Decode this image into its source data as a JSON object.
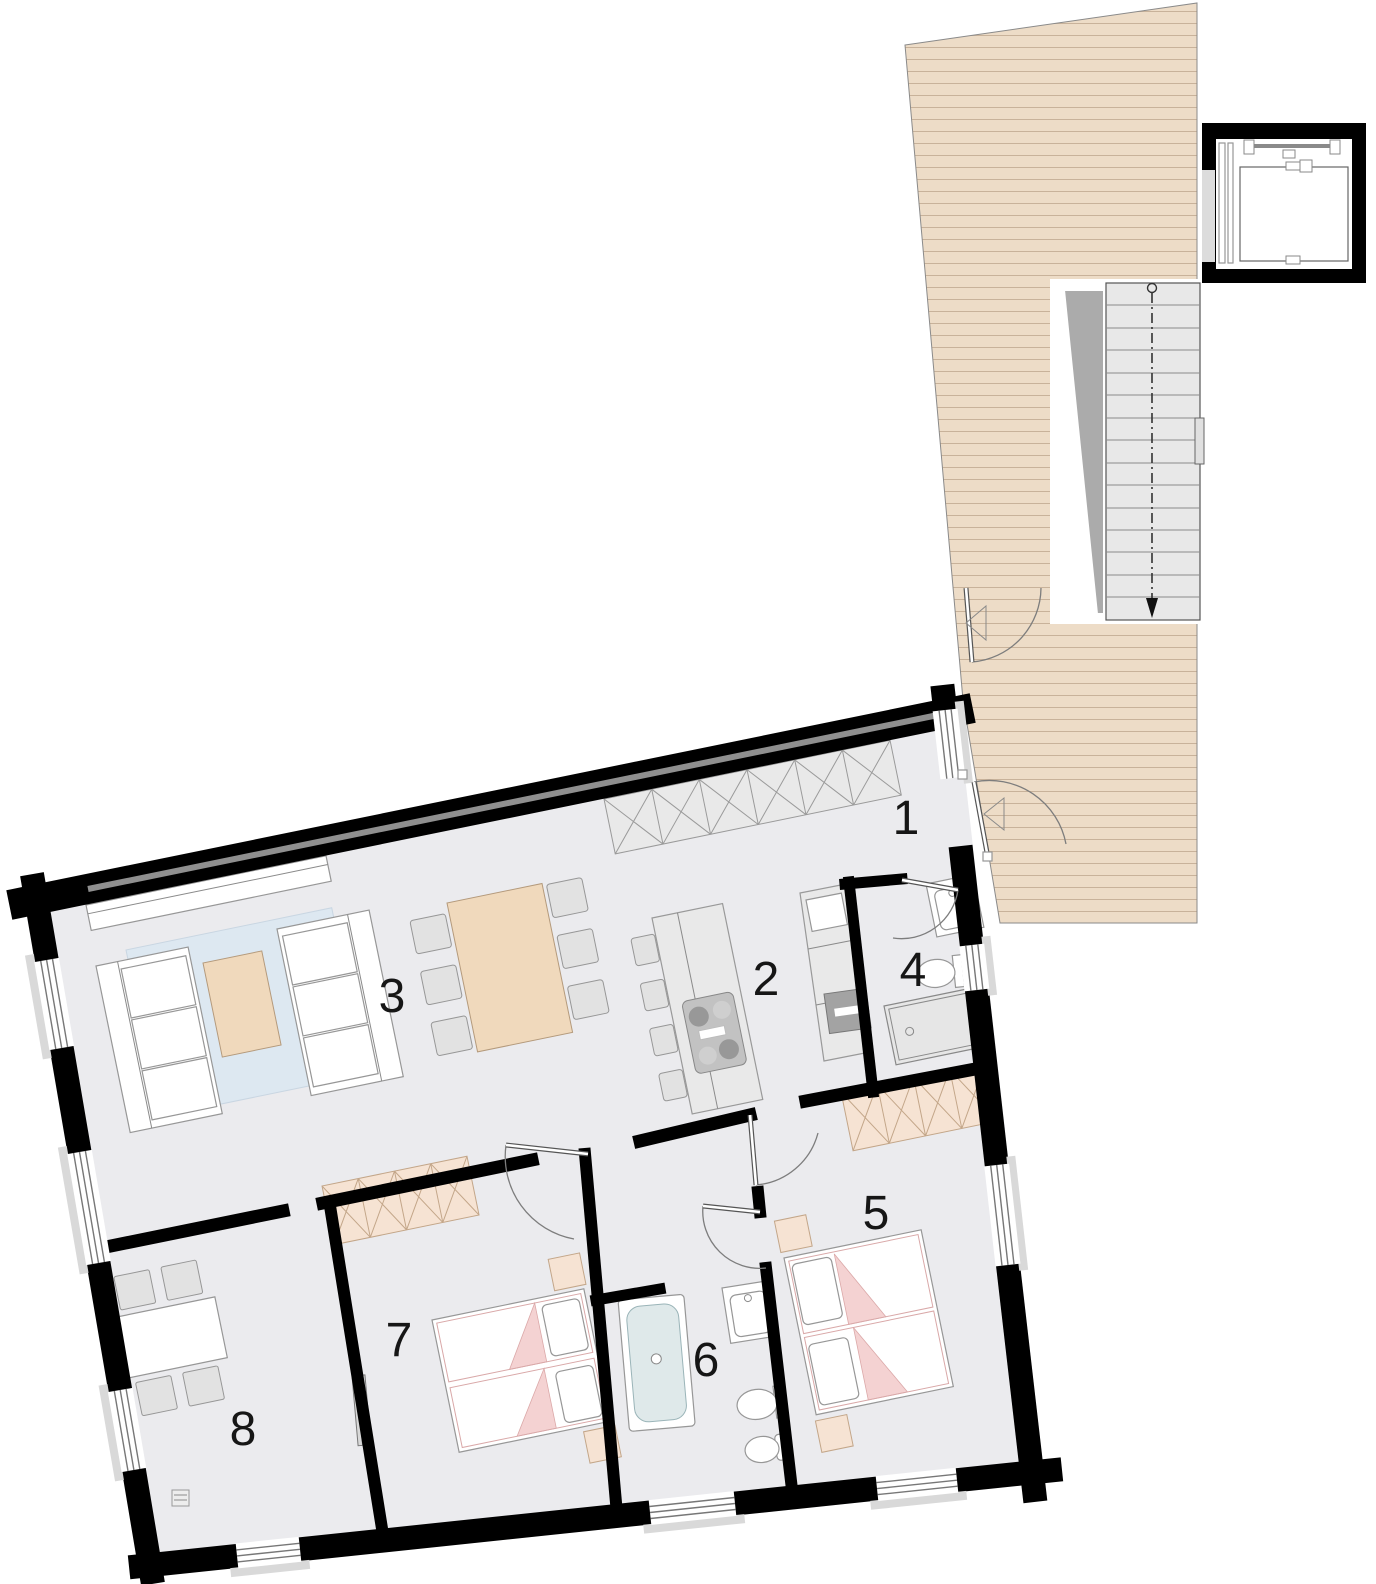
{
  "rooms": [
    {
      "number": "1"
    },
    {
      "number": "2"
    },
    {
      "number": "3"
    },
    {
      "number": "4"
    },
    {
      "number": "5"
    },
    {
      "number": "6"
    },
    {
      "number": "7"
    },
    {
      "number": "8"
    }
  ],
  "colors": {
    "wall": "#000000",
    "floor": "#ebebee",
    "deck": "#eddcc7",
    "deck_line": "#c8b29a",
    "stair_tread": "#e8e8e8",
    "stair_void": "#ababab",
    "rug": "#dde8f1",
    "furniture_wood": "#f0d9bc",
    "wardrobe_wood": "#f6e3d3",
    "closet_gray": "#e9e9e9",
    "bed_accent": "#f4d2d2",
    "tub_water": "#dfe9ea",
    "counter_gray": "#e9e9e9",
    "cooktop": "#c2c2c2",
    "sink_dark": "#a3a3a3"
  }
}
